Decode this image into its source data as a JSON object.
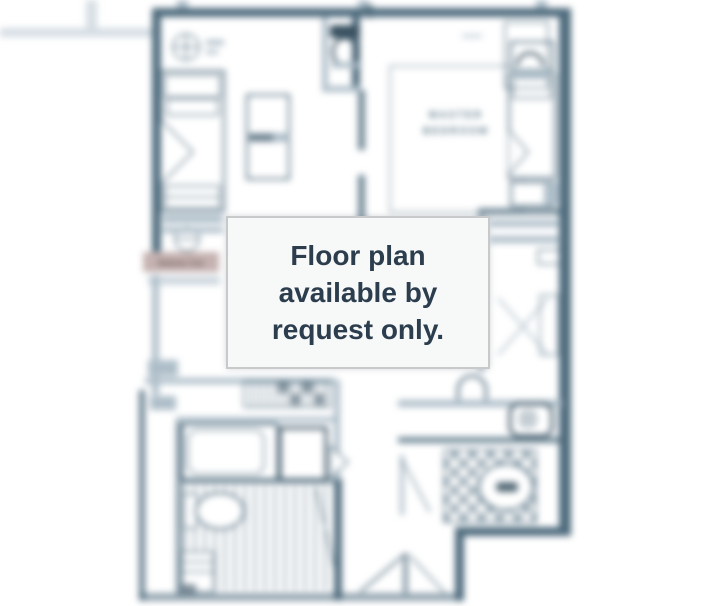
{
  "overlay": {
    "lines": [
      "Floor plan",
      "available by",
      "request only."
    ]
  },
  "plan": {
    "master_bedroom_label": {
      "line1": "MASTER",
      "line2": "BEDROOM"
    },
    "watermark_label": "Selene Cor"
  },
  "colors": {
    "ink": "#4e6b7d",
    "ink_dark": "#3a5262",
    "ink_light": "#aebec9",
    "room_label": "#5e7a8b",
    "rose_bg": "#c5b2b1",
    "rose_text": "#6e5c5c",
    "overlay_bg": "#f7f8f8",
    "overlay_border": "#c7c9ca",
    "overlay_text": "#2c3d4e"
  }
}
